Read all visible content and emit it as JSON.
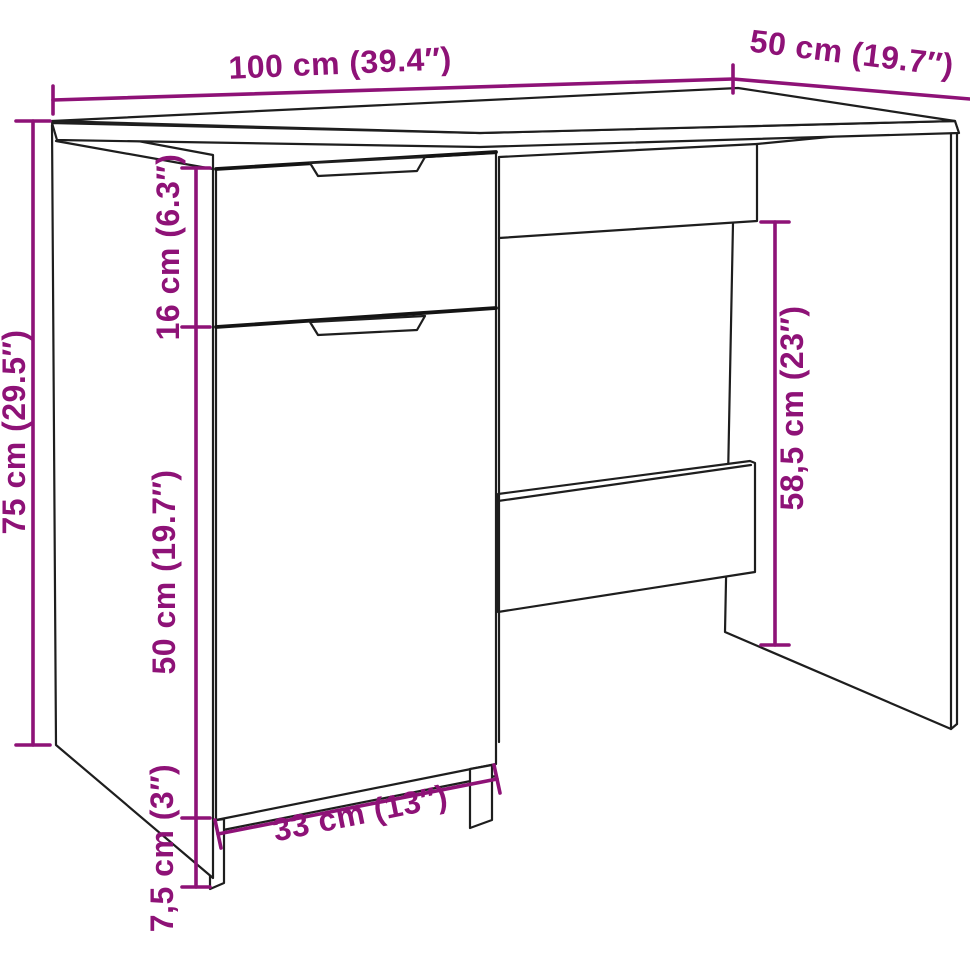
{
  "diagram": {
    "kind": "furniture-dimension-diagram",
    "colors": {
      "dimension": "#8e1277",
      "outline": "#1e1e1e",
      "background": "#ffffff"
    },
    "dimensions": {
      "total_width": {
        "label": "100 cm (39.4″)"
      },
      "total_depth": {
        "label": "50 cm (19.7″)"
      },
      "total_height": {
        "label": "75 cm (29.5″)"
      },
      "drawer_height": {
        "label": "16 cm (6.3″)"
      },
      "door_height": {
        "label": "50 cm (19.7″)"
      },
      "clearance_height": {
        "label": "58,5 cm (23″)"
      },
      "base_height": {
        "label": "7,5 cm (3″)"
      },
      "door_width": {
        "label": "33 cm (13″)"
      }
    }
  }
}
